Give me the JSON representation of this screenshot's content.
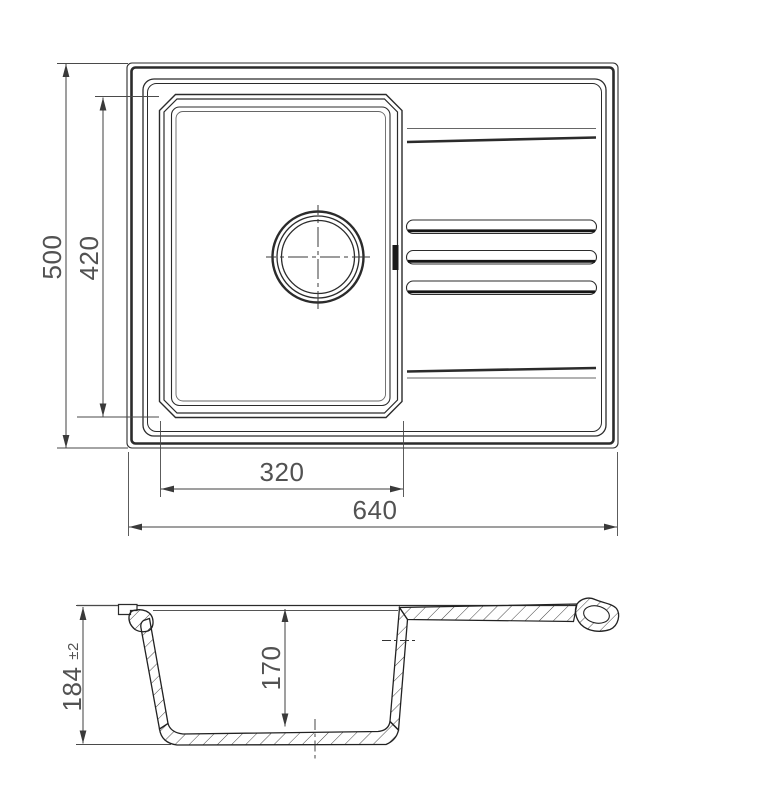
{
  "drawing": {
    "background": "#ffffff",
    "line_color": "#2b2b2b",
    "dim_color": "#3f3f3f",
    "text_color": "#525252"
  },
  "dimensions": {
    "plan": {
      "overall_height": "500",
      "bowl_length": "420",
      "bowl_width": "320",
      "overall_width": "640"
    },
    "section": {
      "overall_depth": "184",
      "overall_depth_tolerance": "±2",
      "bowl_depth": "170"
    }
  }
}
